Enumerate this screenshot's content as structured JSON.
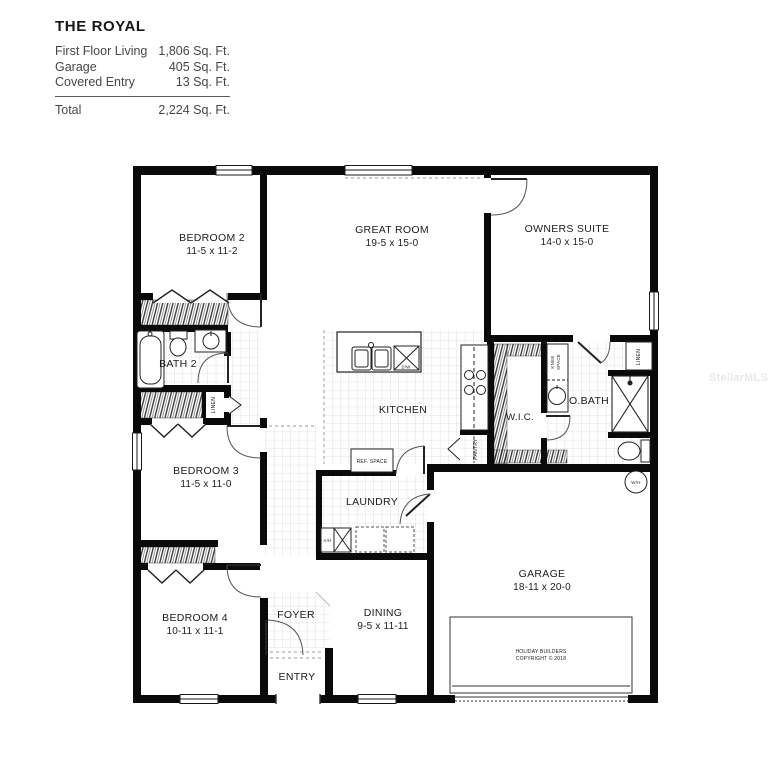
{
  "title_block": {
    "plan_name": "THE ROYAL",
    "areas": [
      {
        "label": "First Floor Living",
        "value": "1,806 Sq. Ft."
      },
      {
        "label": "Garage",
        "value": "405 Sq. Ft."
      },
      {
        "label": "Covered Entry",
        "value": "13 Sq. Ft."
      }
    ],
    "total": {
      "label": "Total",
      "value": "2,224 Sq. Ft."
    }
  },
  "rooms": {
    "bedroom2": {
      "name": "BEDROOM 2",
      "dims": "11-5 x 11-2"
    },
    "great_room": {
      "name": "GREAT ROOM",
      "dims": "19-5 x 15-0"
    },
    "owners_suite": {
      "name": "OWNERS SUITE",
      "dims": "14-0 x 15-0"
    },
    "bath2": {
      "name": "BATH 2"
    },
    "bedroom3": {
      "name": "BEDROOM 3",
      "dims": "11-5 x 11-0"
    },
    "kitchen": {
      "name": "KITCHEN"
    },
    "wic": {
      "name": "W.I.C."
    },
    "obath": {
      "name": "O.BATH"
    },
    "laundry": {
      "name": "LAUNDRY"
    },
    "bedroom4": {
      "name": "BEDROOM 4",
      "dims": "10-11 x 11-1"
    },
    "foyer": {
      "name": "FOYER"
    },
    "dining": {
      "name": "DINING",
      "dims": "9-5 x 11-11"
    },
    "entry": {
      "name": "ENTRY"
    },
    "garage": {
      "name": "GARAGE",
      "dims": "18-11 x 20-0"
    }
  },
  "labels": {
    "linen_hall": "LINEN",
    "linen_obath": "LINEN",
    "pantry": "PANTRY",
    "ref_space": "REF. SPACE",
    "knee_line1": "KNEE",
    "knee_line2": "SPACE",
    "air_handler": "A/H",
    "water_heater": "W/H",
    "dishwasher": "D/W"
  },
  "copyright": {
    "line1": "HOLIDAY BUILDERS",
    "line2": "COPYRIGHT © 2018"
  },
  "watermark": "StellarMLS",
  "colors": {
    "wall": "#0a0a0a",
    "background": "#ffffff",
    "tile_line": "#c9c9c9"
  }
}
